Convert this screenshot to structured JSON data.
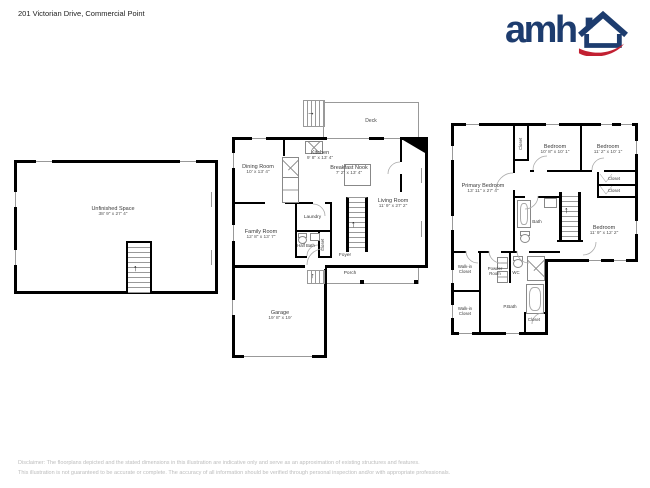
{
  "header": {
    "address": "201 Victorian Drive, Commercial Point",
    "brand": "amh"
  },
  "colors": {
    "logo_blue": "#1d3c6e",
    "logo_red": "#c22032",
    "wall": "#000000",
    "thin_line": "#999999",
    "disclaimer_gray": "#bdbdbd"
  },
  "icons": {
    "arrow_up": "↑",
    "arrow_right": "→"
  },
  "floors": {
    "basement": {
      "unfinished": {
        "name": "Unfinished Space",
        "dims": "38' 9\" x 27' 4\""
      }
    },
    "main": {
      "deck": {
        "name": "Deck"
      },
      "dining": {
        "name": "Dining Room",
        "dims": "10' x 13' 4\""
      },
      "kitchen": {
        "name": "Kitchen",
        "dims": "9' 8\" x 13' 4\""
      },
      "nook": {
        "name": "Breakfast Nook",
        "dims": "7' 2\" x 13' 4\""
      },
      "living": {
        "name": "Living Room",
        "dims": "11' 9\" x 27' 2\""
      },
      "family": {
        "name": "Family Room",
        "dims": "12' 8\" x 13' 7\""
      },
      "laundry": {
        "name": "Laundry"
      },
      "halfbath": {
        "name": "Half Bath"
      },
      "closet": {
        "name": "Closet"
      },
      "foyer": {
        "name": "Foyer"
      },
      "porch": {
        "name": "Porch"
      },
      "garage": {
        "name": "Garage",
        "dims": "19' 8\" x 19'"
      }
    },
    "upper": {
      "primary": {
        "name": "Primary Bedroom",
        "dims": "13' 11\" x 27' 4\""
      },
      "closet_top": {
        "name": "Closet"
      },
      "bedroom2": {
        "name": "Bedroom",
        "dims": "10' 8\" x 10' 1\""
      },
      "bedroom3": {
        "name": "Bedroom",
        "dims": "11' 2\" x 10' 1\""
      },
      "closet_r1": {
        "name": "Closet"
      },
      "closet_r2": {
        "name": "Closet"
      },
      "bath": {
        "name": "Bath"
      },
      "bedroom4": {
        "name": "Bedroom",
        "dims": "11' 9\" x 12' 2\""
      },
      "wic1": {
        "name": "Walk-in Closet"
      },
      "wic2": {
        "name": "Walk-in Closet"
      },
      "powder": {
        "name": "Powder Room"
      },
      "wc": {
        "name": "WC"
      },
      "pbath": {
        "name": "P.Bath"
      },
      "closet_b": {
        "name": "Closet"
      }
    }
  },
  "footer": {
    "line1": "Disclaimer: The floorplans depicted and the stated dimensions in this illustration are indicative only and serve as an approximation of existing structures and features.",
    "line2": "This illustration is not guaranteed to be accurate or complete. The accuracy of all information should be verified through personal inspection and/or with appropriate professionals."
  }
}
